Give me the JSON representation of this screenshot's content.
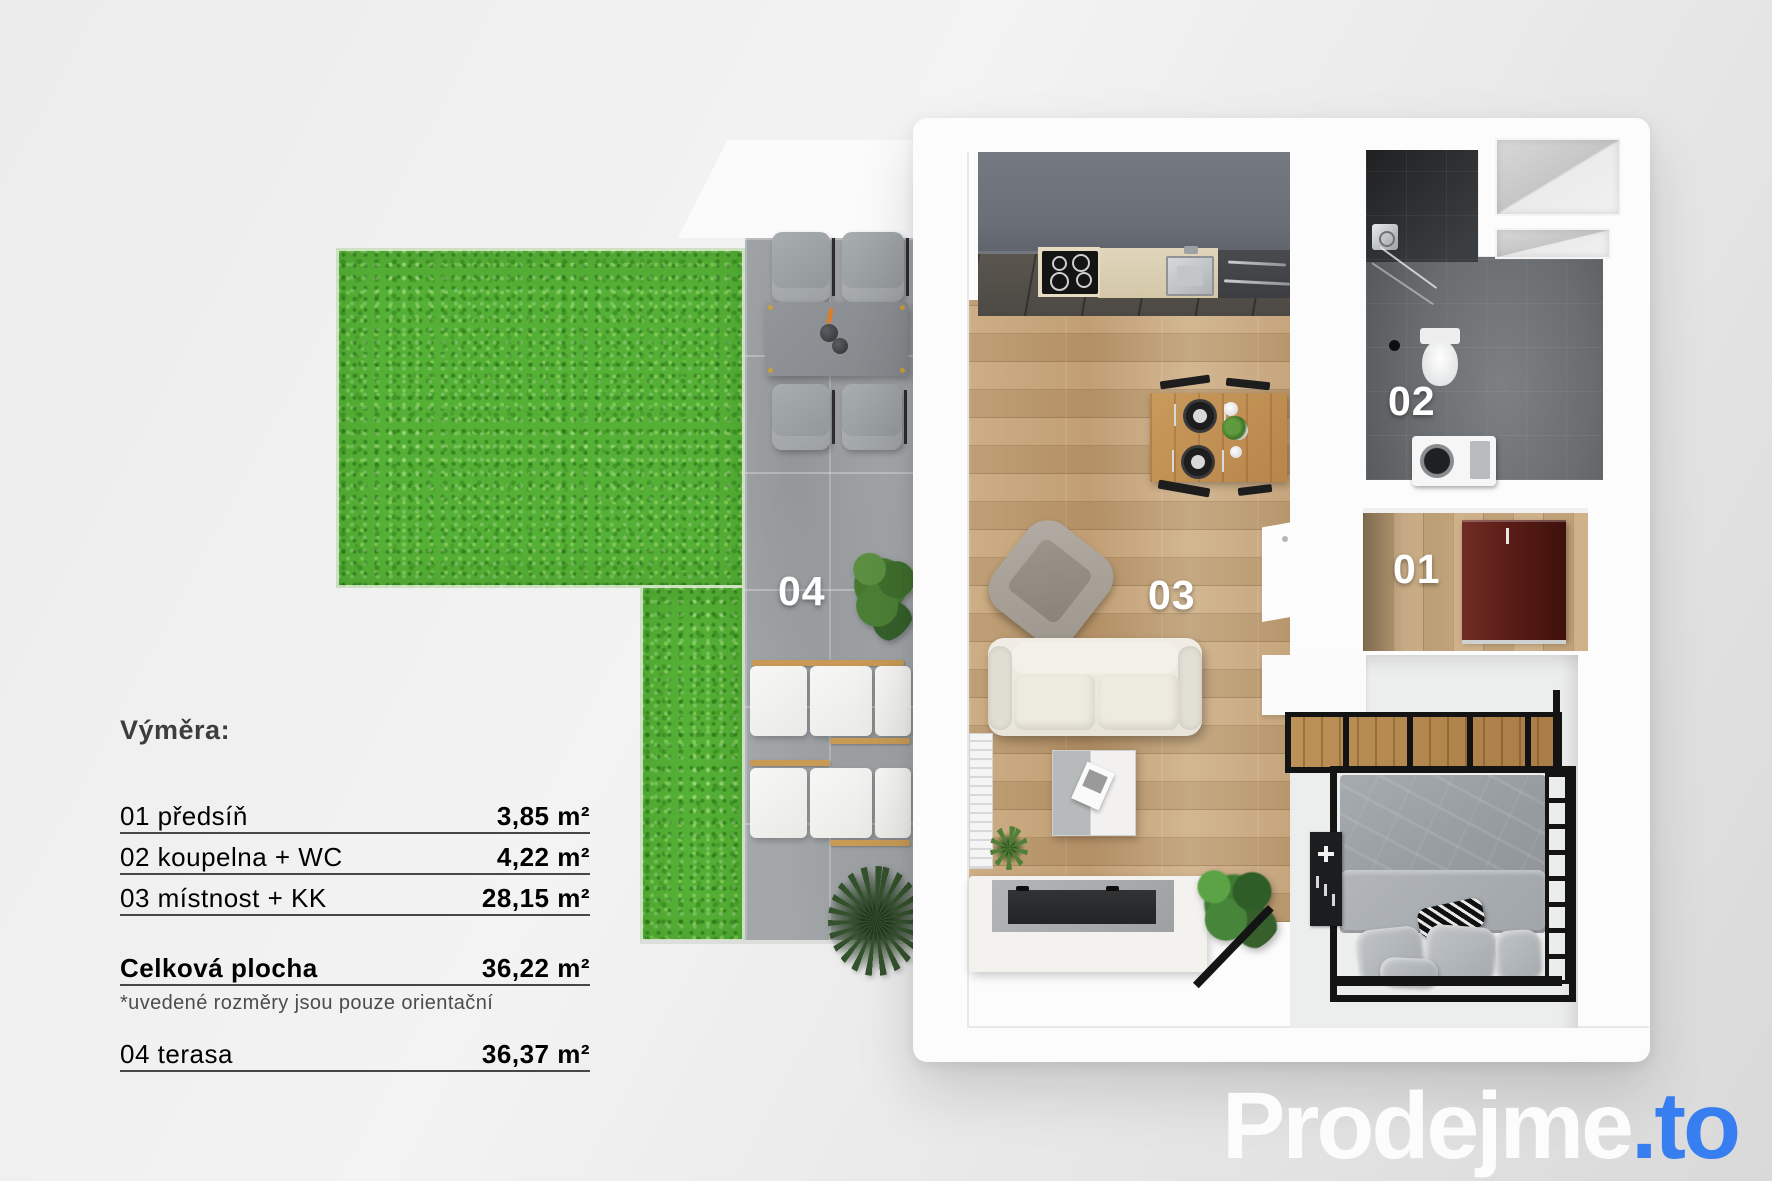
{
  "legend": {
    "title": "Výměra:",
    "rows": [
      {
        "label": "01 předsíň",
        "value": "3,85 m²"
      },
      {
        "label": "02 koupelna + WC",
        "value": "4,22 m²"
      },
      {
        "label": "03 místnost + KK",
        "value": "28,15 m²"
      }
    ],
    "total": {
      "label": "Celková plocha",
      "value": "36,22 m²"
    },
    "note": "*uvedené rozměry jsou pouze orientační",
    "terrace_row": {
      "label": "04 terasa",
      "value": "36,37 m²"
    }
  },
  "plan": {
    "room_labels": {
      "hall": "01",
      "bathroom": "02",
      "living": "03",
      "terrace": "04"
    }
  },
  "logo": {
    "text": "Prodejme",
    "tld": ".to"
  },
  "colors": {
    "brand_blue": "#377ef0",
    "logo_white": "#fcfcfc",
    "grass_green": "#55b036",
    "concrete_gray": "#a3a7a9",
    "wood_floor": "#c5a277",
    "kitchen_cabinet": "#6a6f77",
    "bathroom_tile": "#4a4c4e",
    "wardrobe_red": "#5a1d16",
    "label_white": "#ffffff",
    "legend_text": "#3d3d3d"
  }
}
